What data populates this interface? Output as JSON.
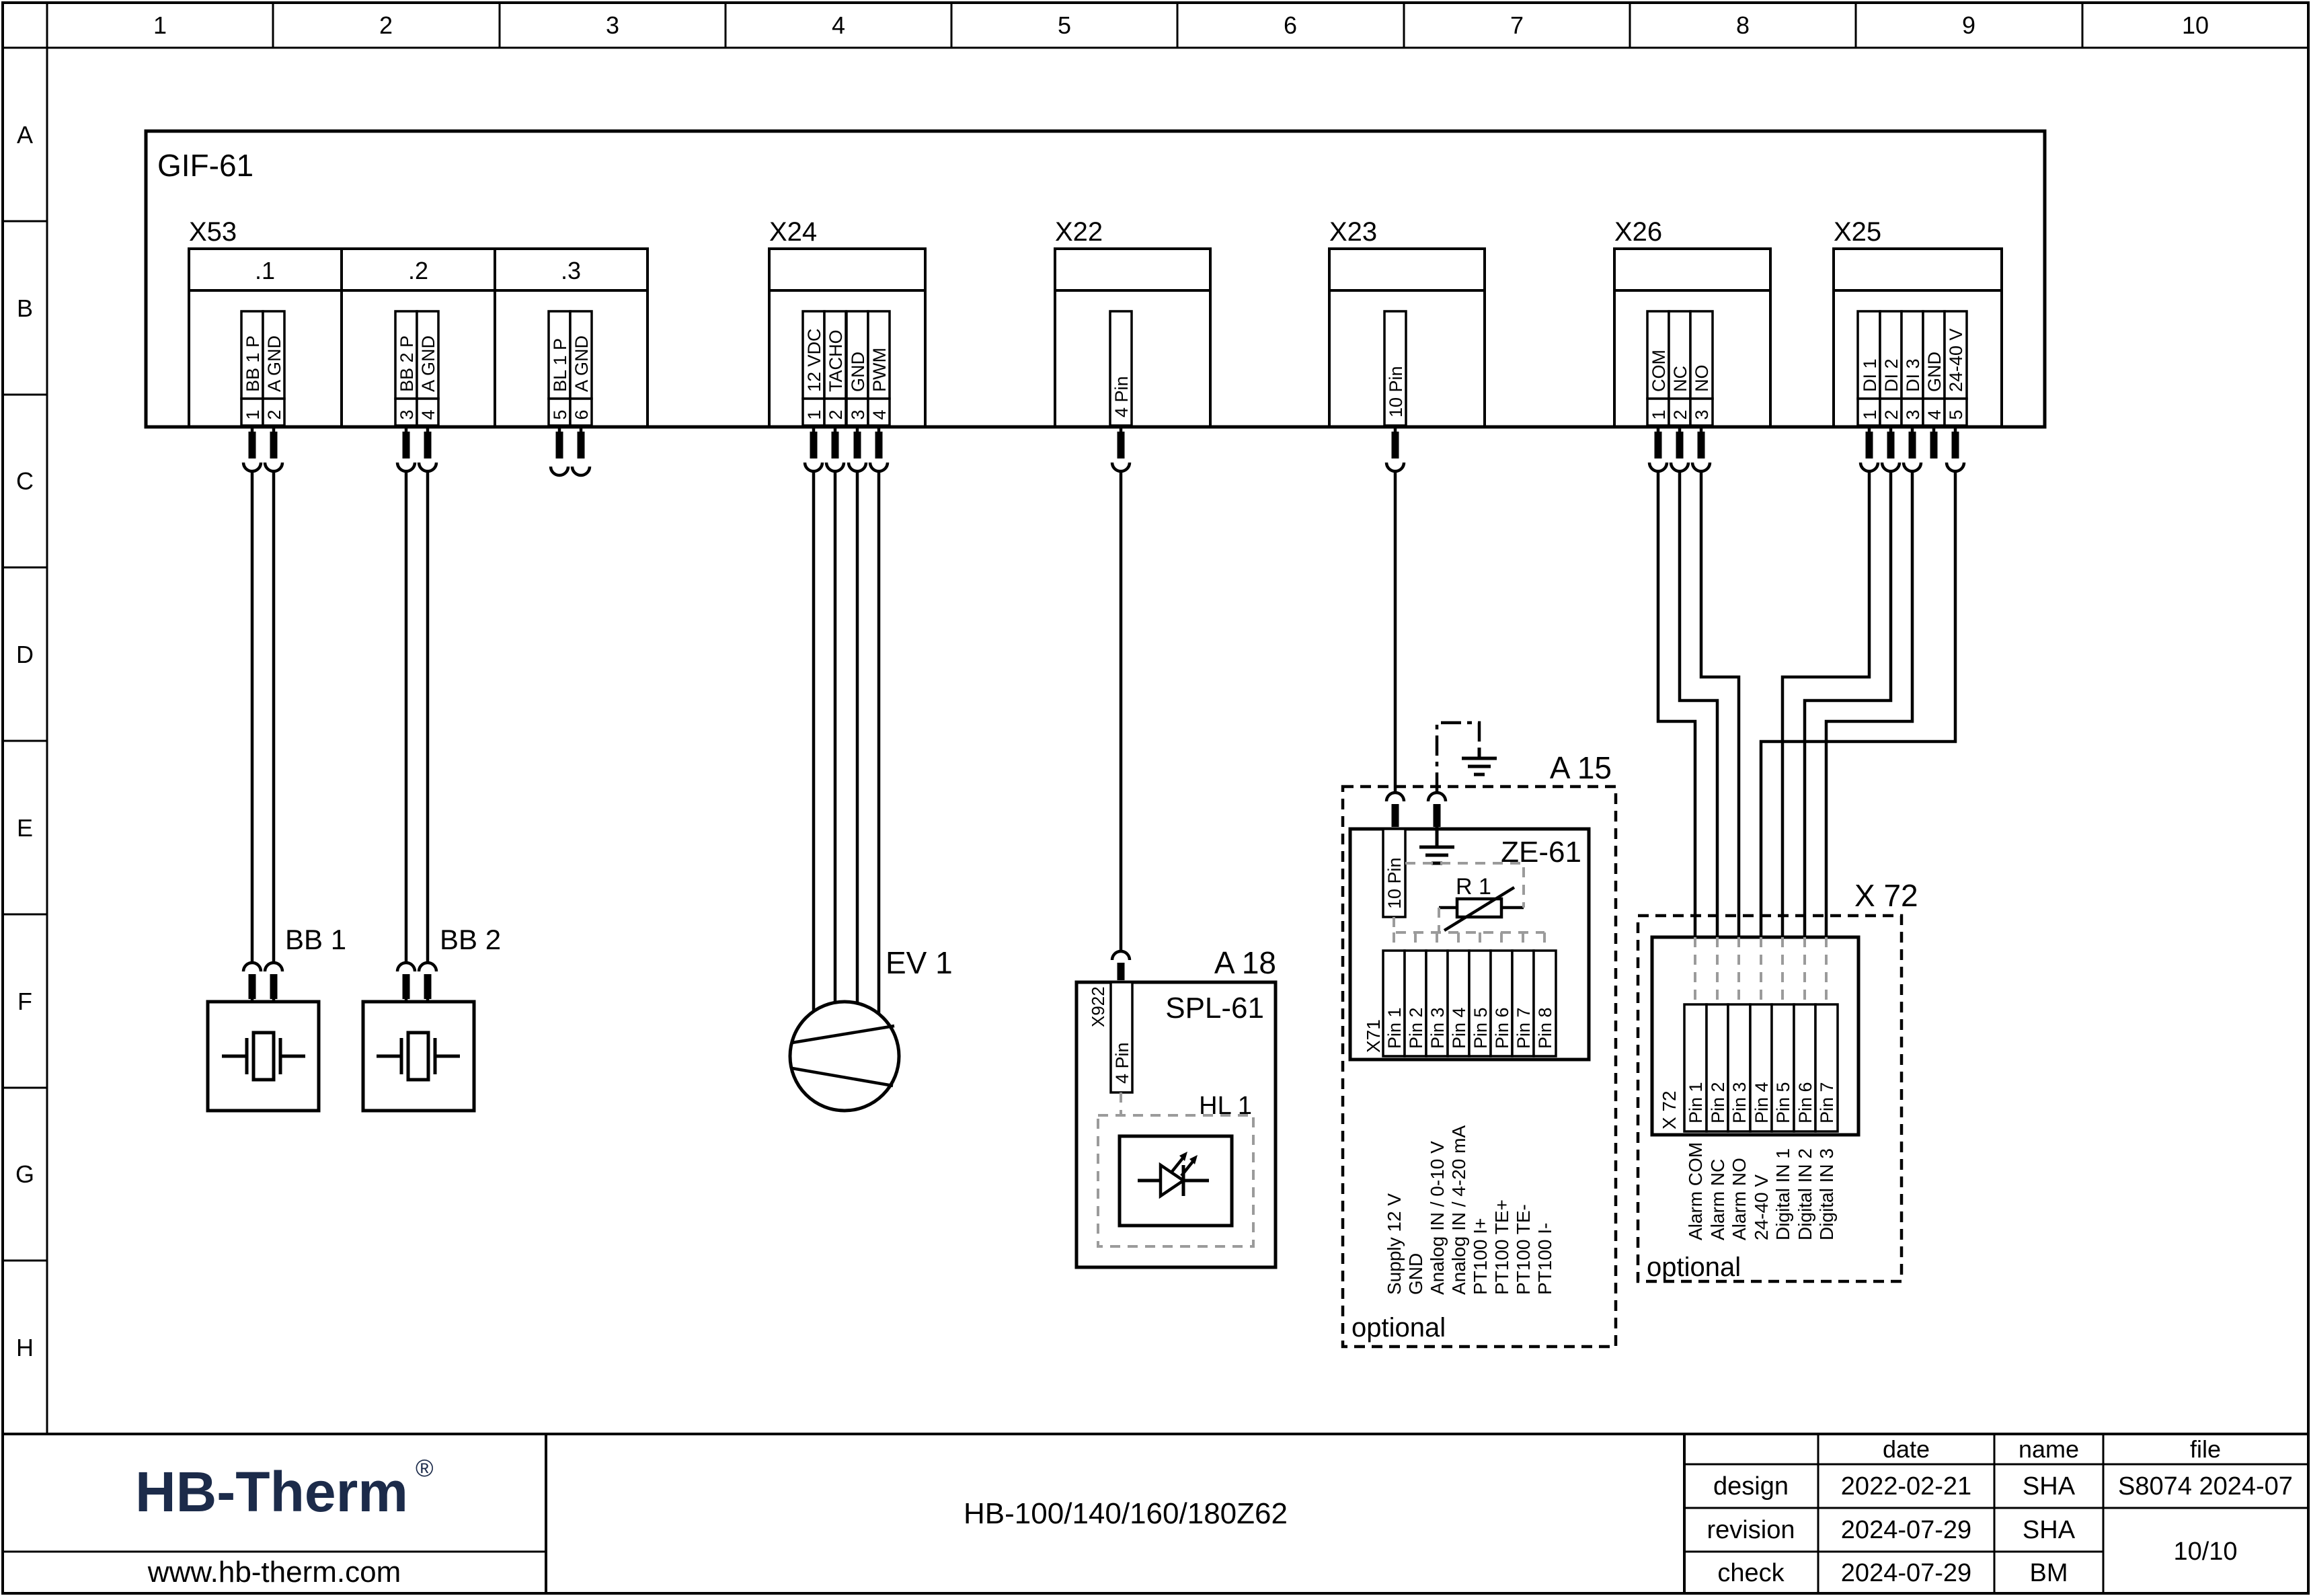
{
  "frame": {
    "columns": [
      "1",
      "2",
      "3",
      "4",
      "5",
      "6",
      "7",
      "8",
      "9",
      "10"
    ],
    "rows": [
      "A",
      "B",
      "C",
      "D",
      "E",
      "F",
      "G",
      "H"
    ]
  },
  "board": {
    "label": "GIF-61"
  },
  "connectors": {
    "x53": {
      "label": "X53",
      "groups": [
        {
          "label": ".1",
          "pins": [
            {
              "num": "1",
              "name": "BB 1 P"
            },
            {
              "num": "2",
              "name": "A GND"
            }
          ]
        },
        {
          "label": ".2",
          "pins": [
            {
              "num": "3",
              "name": "BB 2 P"
            },
            {
              "num": "4",
              "name": "A GND"
            }
          ]
        },
        {
          "label": ".3",
          "pins": [
            {
              "num": "5",
              "name": "BL 1 P"
            },
            {
              "num": "6",
              "name": "A GND"
            }
          ]
        }
      ]
    },
    "x24": {
      "label": "X24",
      "pins": [
        {
          "num": "1",
          "name": "12 VDC"
        },
        {
          "num": "2",
          "name": "TACHO"
        },
        {
          "num": "3",
          "name": "GND"
        },
        {
          "num": "4",
          "name": "PWM"
        }
      ]
    },
    "x22": {
      "label": "X22",
      "pin_name": "4 Pin"
    },
    "x23": {
      "label": "X23",
      "pin_name": "10 Pin"
    },
    "x26": {
      "label": "X26",
      "pins": [
        {
          "num": "1",
          "name": "COM"
        },
        {
          "num": "2",
          "name": "NC"
        },
        {
          "num": "3",
          "name": "NO"
        }
      ]
    },
    "x25": {
      "label": "X25",
      "pins": [
        {
          "num": "1",
          "name": "DI 1"
        },
        {
          "num": "2",
          "name": "DI 2"
        },
        {
          "num": "3",
          "name": "DI 3"
        },
        {
          "num": "4",
          "name": "GND"
        },
        {
          "num": "5",
          "name": "24-40 V"
        }
      ]
    }
  },
  "components": {
    "bb1": {
      "label": "BB 1"
    },
    "bb2": {
      "label": "BB 2"
    },
    "ev1": {
      "label": "EV 1"
    },
    "a18": {
      "label": "A 18",
      "board": "SPL-61",
      "connector": "X922",
      "connector_pin": "4 Pin",
      "lamp": "HL 1"
    },
    "a15": {
      "label": "A 15",
      "board": "ZE-61",
      "connector_pin": "10 Pin",
      "resistor": "R 1",
      "x71_label": "X71",
      "x71_pins": [
        "Pin 1",
        "Pin 2",
        "Pin 3",
        "Pin 4",
        "Pin 5",
        "Pin 6",
        "Pin 7",
        "Pin 8"
      ],
      "x71_signals": [
        "Supply 12 V",
        "GND",
        "Analog IN / 0-10 V",
        "Analog IN / 4-20 mA",
        "PT100 I+",
        "PT100 TE+",
        "PT100 TE-",
        "PT100 I-"
      ],
      "optional": "optional"
    },
    "x72": {
      "label": "X 72",
      "connector_label": "X 72",
      "pins": [
        "Pin 1",
        "Pin 2",
        "Pin 3",
        "Pin 4",
        "Pin 5",
        "Pin 6",
        "Pin 7"
      ],
      "signals": [
        "Alarm COM",
        "Alarm NC",
        "Alarm NO",
        "24-40 V",
        "Digital IN 1",
        "Digital IN 2",
        "Digital IN 3"
      ],
      "optional": "optional"
    }
  },
  "title_block": {
    "logo": "HB-Therm",
    "logo_reg": "®",
    "logo_color": "#1c2b4a",
    "website": "www.hb-therm.com",
    "drawing_title": "HB-100/140/160/180Z62",
    "table": {
      "col_date": "date",
      "col_name": "name",
      "col_file": "file",
      "rows": [
        {
          "label": "design",
          "date": "2022-02-21",
          "name": "SHA"
        },
        {
          "label": "revision",
          "date": "2024-07-29",
          "name": "SHA"
        },
        {
          "label": "check",
          "date": "2024-07-29",
          "name": "BM"
        }
      ],
      "file_value": "S8074 2024-07",
      "page": "10/10"
    }
  }
}
